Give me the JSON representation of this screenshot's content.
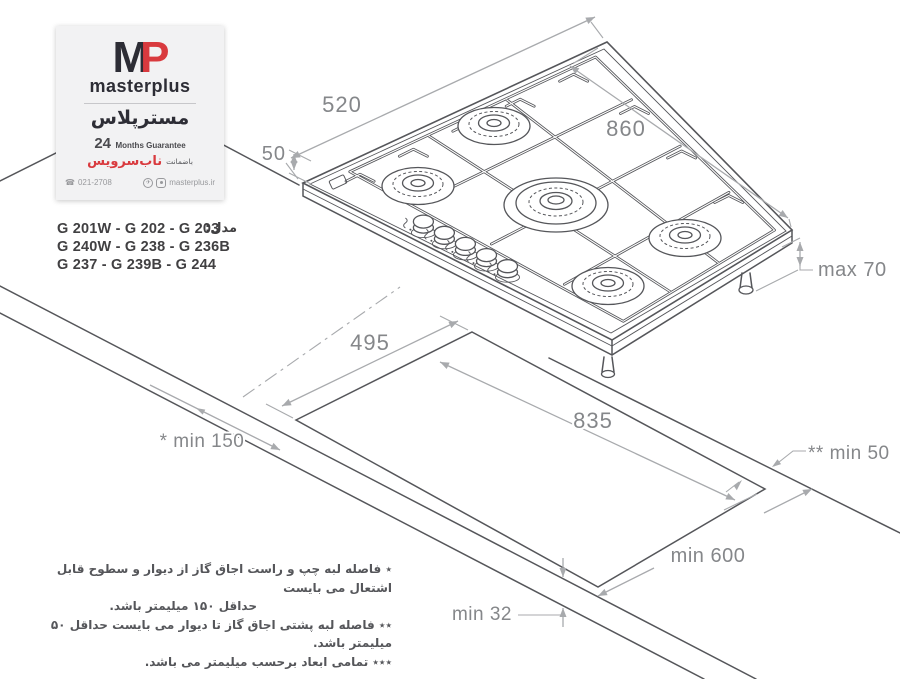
{
  "colors": {
    "accent_red": "#d93a3e",
    "line_dark": "#55565a",
    "line_light": "#a8aaad",
    "dim_text": "#85878a",
    "card_bg": "#f2f2f3"
  },
  "card": {
    "logo_m": "M",
    "logo_p": "P",
    "brand": "masterplus",
    "brand_fa": "مسترپلاس",
    "guarantee_number": "24",
    "guarantee_text": "Months Guarantee",
    "warranty_prefix_fa": "باضمانت",
    "warranty_brand_fa": "ناب‌سرویس",
    "phone": "021-2708",
    "website": "masterplus.ir"
  },
  "icons": {
    "phone": "☎",
    "telegram": "✈"
  },
  "models": {
    "label_fa": "مدل:",
    "rows": [
      "G 201W - G 202 - G 203",
      "G 240W - G 238 - G 236B",
      "G 237 - G 239B - G 244"
    ]
  },
  "dims": {
    "hob_depth": "520",
    "hob_width": "860",
    "edge_height": "50",
    "max_height": "max 70",
    "cutout_depth": "495",
    "cutout_width": "835",
    "side_clearance": "* min 150",
    "rear_clearance": "** min 50",
    "counter_depth": "min 600",
    "counter_thickness": "min 32"
  },
  "notes": [
    "٭ فاصله لبه چپ و راست اجاق گاز از دیوار و سطوح قابل اشتعال می بایست",
    "حداقل ۱۵۰ میلیمتر باشد.",
    "٭٭ فاصله لبه پشتی اجاق گاز تا دیوار می بایست حداقل ۵۰ میلیمتر باشد.",
    "٭٭٭ تمامی ابعاد برحسب میلیمتر می باشد."
  ]
}
